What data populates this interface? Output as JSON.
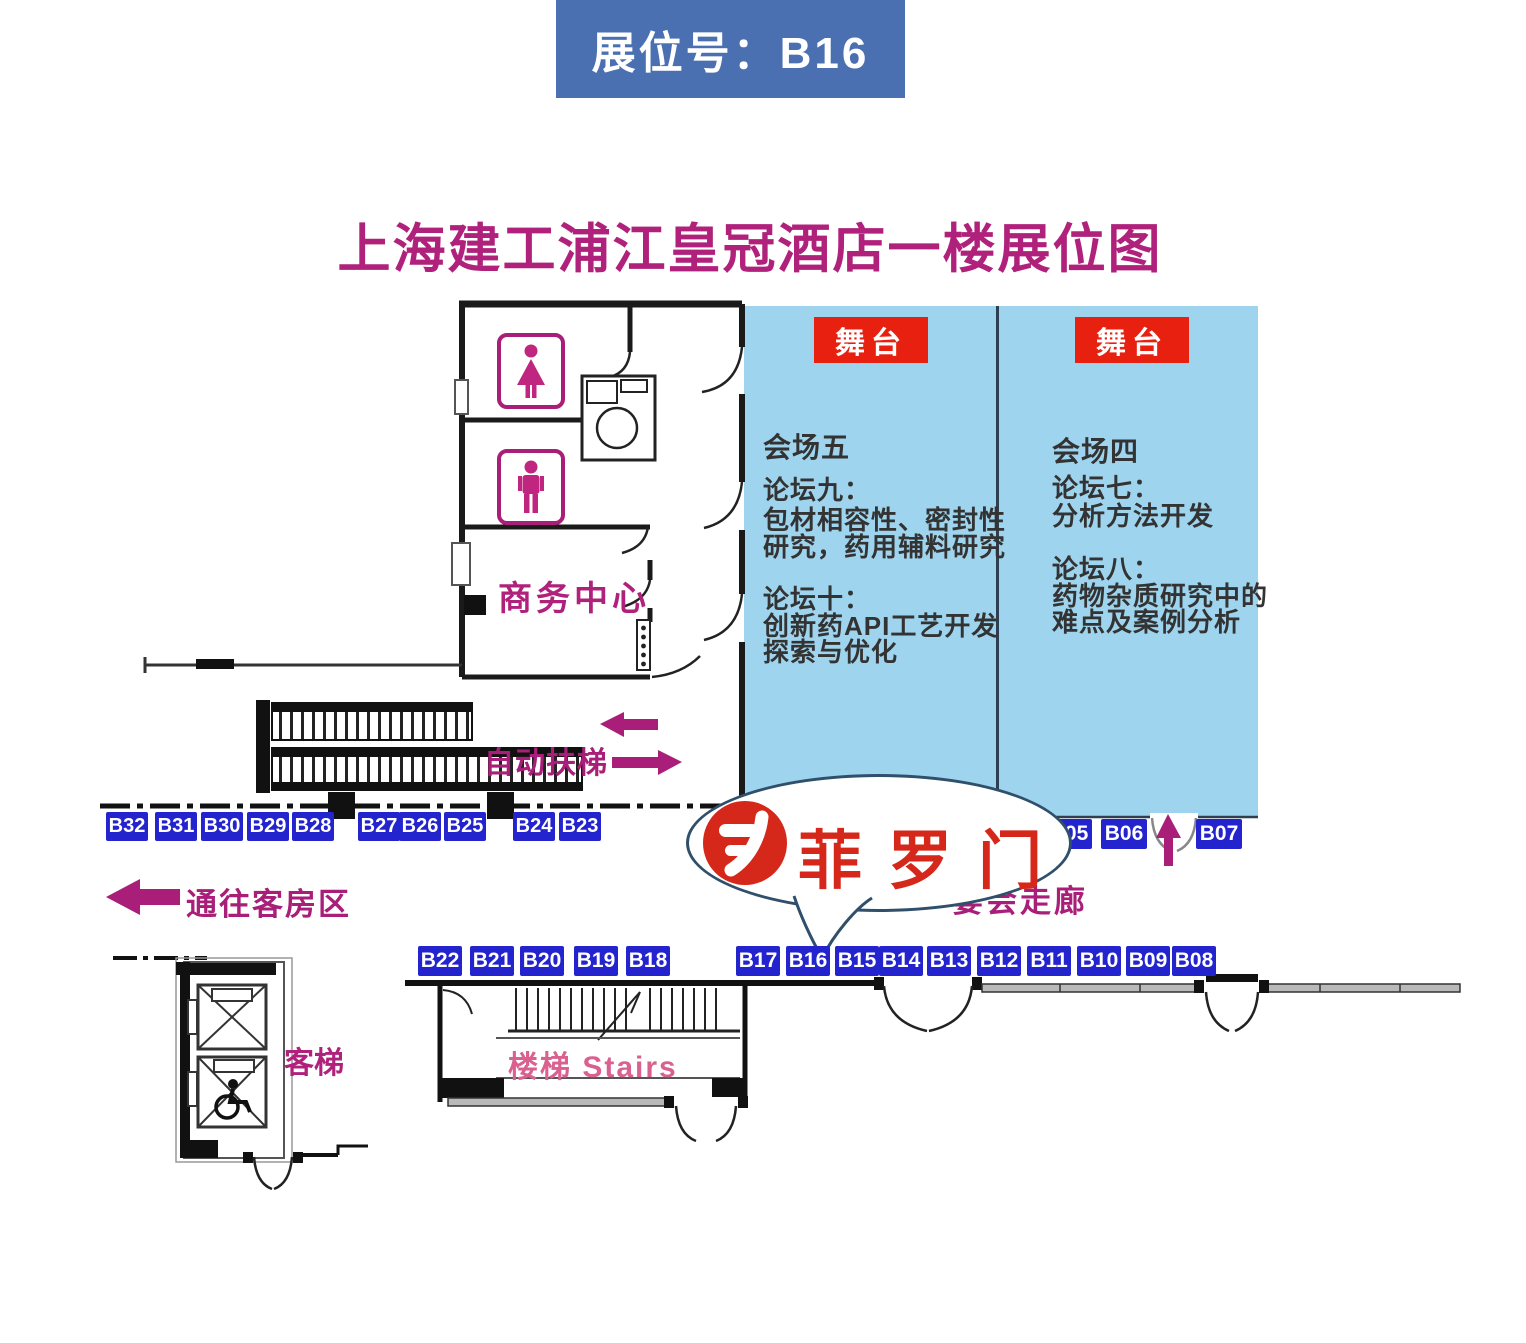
{
  "header": {
    "badge": "展位号：B16"
  },
  "title": "上海建工浦江皇冠酒店一楼展位图",
  "venues": {
    "left": {
      "stage": "舞台",
      "name": "会场五",
      "forum_a_title": "论坛九：",
      "forum_a_line1": "包材相容性、密封性",
      "forum_a_line2": "研究，药用辅料研究",
      "forum_b_title": "论坛十：",
      "forum_b_line1": "创新药API工艺开发",
      "forum_b_line2": "探索与优化"
    },
    "right": {
      "stage": "舞台",
      "name": "会场四",
      "forum_a_title": "论坛七：",
      "forum_a_line1": "分析方法开发",
      "forum_b_title": "论坛八：",
      "forum_b_line1": "药物杂质研究中的",
      "forum_b_line2": "难点及案例分析"
    }
  },
  "booths": {
    "top_row": [
      "B32",
      "B31",
      "B30",
      "B29",
      "B28",
      "B27",
      "B26",
      "B25",
      "B24",
      "B23"
    ],
    "right_row": [
      "B05",
      "B06",
      "B07"
    ],
    "bottom_row": [
      "B22",
      "B21",
      "B20",
      "B19",
      "B18",
      "B17",
      "B16",
      "B15",
      "B14",
      "B13",
      "B12",
      "B11",
      "B10",
      "B09",
      "B08"
    ]
  },
  "labels": {
    "business_center": "商务中心",
    "escalator": "自动扶梯",
    "to_guest_rooms": "通往客房区",
    "corridor": "宴会走廊",
    "elevator": "客梯",
    "stairs": "楼梯  Stairs",
    "logo_text": "菲罗门"
  },
  "colors": {
    "header_blue": "#4a70b2",
    "booth_blue": "#2424cf",
    "area_blue": "#9ed4ee",
    "stage_red": "#e8200f",
    "magenta": "#a81e78",
    "title_magenta": "#b0217c",
    "logo_red": "#d5271a",
    "stairs_pink": "#d9608f",
    "bubble_border": "#2f4f6b"
  }
}
